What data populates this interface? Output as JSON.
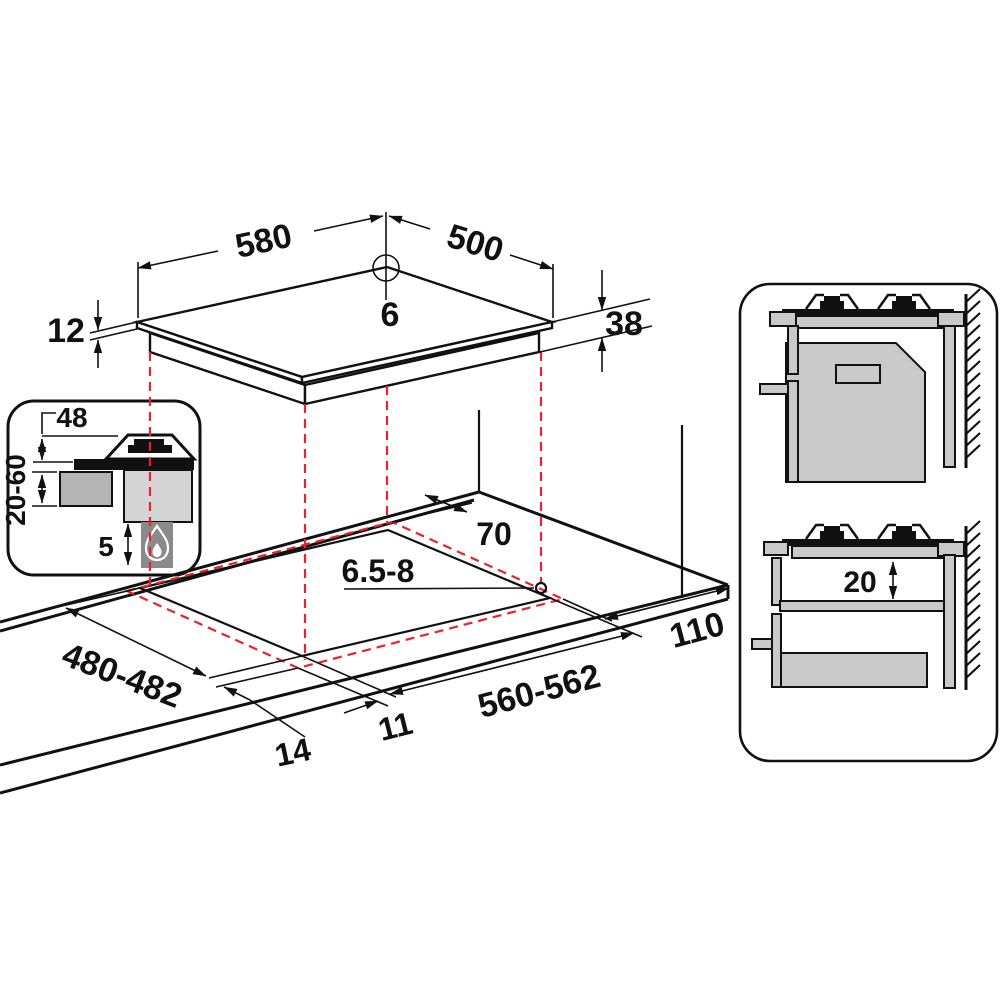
{
  "diagram_title": "gas-hob-installation-dimensions",
  "hob": {
    "width": "580",
    "depth": "500",
    "rear_hole_diameter": "6",
    "glass_thickness": "12",
    "total_height": "38"
  },
  "inset_section": {
    "height_above_worktop": "48",
    "worktop_thickness_range": "20-60",
    "clearance_below_hob": "5",
    "flame_icon": "gas-flame-icon"
  },
  "cutout_plan": {
    "rear_clearance": "70",
    "fixing_hole_diameter": "6.5-8",
    "side_clearance": "110",
    "cutout_width": "560-562",
    "cutout_depth": "480-482",
    "edge_offset_left": "14",
    "edge_offset_front": "11"
  },
  "side_view_panel": {
    "shelf_clearance": "20"
  },
  "colors": {
    "line": "#111111",
    "dashed_red": "#e8232d",
    "gray_light": "#c9c9c9",
    "gray_mid": "#b4b4b4",
    "gray_body": "#d4d4d4",
    "gray_dark": "#8a8a8a"
  }
}
